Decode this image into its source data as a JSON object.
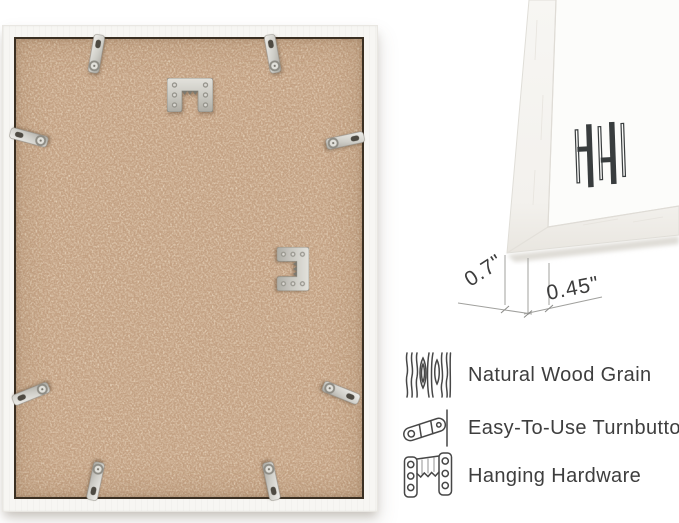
{
  "image_kind": "picture-frame product infographic",
  "back_view": {
    "turnbutton_count": 8,
    "sawtooth_hanger_count": 2
  },
  "corner_closeup": {
    "logo_mark": "hh-monogram"
  },
  "dimension_callout": {
    "depth": "0.7\"",
    "face_width": "0.45\""
  },
  "features": [
    {
      "icon": "wood-grain-icon",
      "label": "Natural Wood Grain"
    },
    {
      "icon": "turnbutton-icon",
      "label": "Easy-To-Use Turnbuttons"
    },
    {
      "icon": "hanging-hardware-icon",
      "label": "Hanging Hardware"
    }
  ],
  "colors": {
    "background": "#ffffff",
    "mdf_backing": "#c3a183",
    "frame_white": "#f7f6f3",
    "metal_hardware": "#c9c8c2",
    "text": "#3e3e3e",
    "dimension_lines": "#a0a09d",
    "logo": "#393d3e"
  }
}
